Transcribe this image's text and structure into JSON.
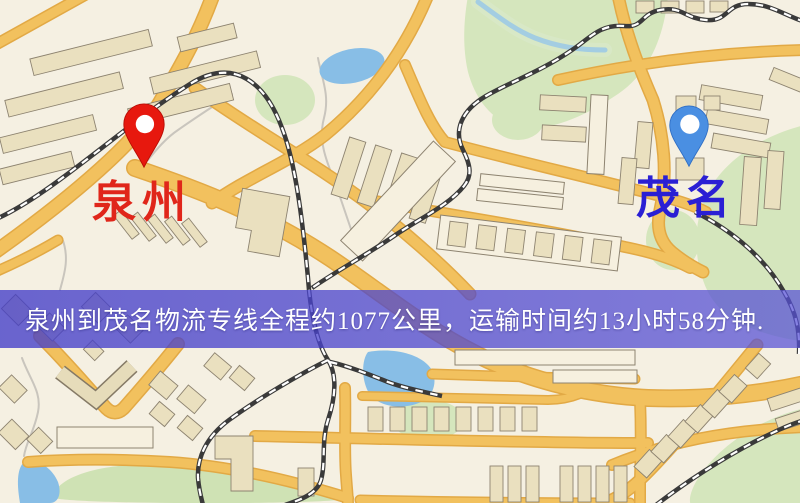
{
  "banner": {
    "text": "泉州到茂名物流专线全程约1077公里，运输时间约13小时58分钟.",
    "bg_color": "rgba(74,68,206,0.75)",
    "text_color": "#ffffff"
  },
  "markers": {
    "quanzhou": {
      "label": "泉州",
      "pin_icon": "red-pin-icon",
      "pin_color": "#e7180e",
      "label_color": "#e0261a"
    },
    "maoming": {
      "label": "茂名",
      "pin_icon": "blue-pin-icon",
      "pin_color": "#4a8fe2",
      "label_color": "#2a1fd4"
    }
  },
  "route": {
    "origin": "泉州",
    "destination": "茂名",
    "distance": "约1077公里",
    "duration": "约13小时58分钟"
  },
  "map_colors": {
    "background": "#f5f0e2",
    "road": "#f2c15e",
    "road_casing": "#e2a945",
    "park": "#d5e6bd",
    "water": "#88bee6",
    "building": "#eae0bf",
    "railway": "#3a3a3a"
  }
}
